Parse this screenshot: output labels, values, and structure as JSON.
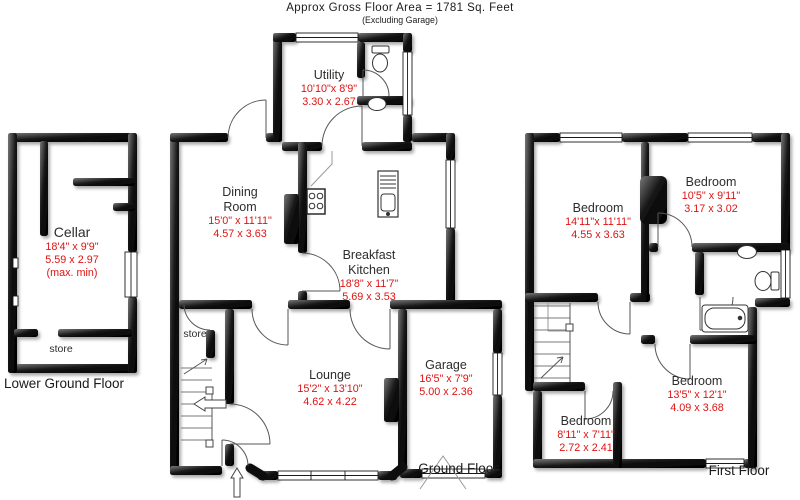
{
  "header": {
    "line1": "Approx Gross Floor Area  =  1781  Sq. Feet",
    "line2": "(Excluding Garage)"
  },
  "floors": {
    "lower_ground": {
      "label": "Lower Ground Floor"
    },
    "ground": {
      "label": "Ground Floor"
    },
    "first": {
      "label": "First Floor"
    }
  },
  "rooms": {
    "cellar": {
      "name": "Cellar",
      "dims_ft": "18'4\" x  9'9\"",
      "dims_m": "5.59  x  2.97",
      "note": "(max. min)"
    },
    "store_lower": {
      "name": "store"
    },
    "store_ground": {
      "name": "store"
    },
    "utility": {
      "name": "Utility",
      "dims_ft": "10'10\"x  8'9\"",
      "dims_m": "3.30  x  2.67"
    },
    "dining_room": {
      "name": "Dining\nRoom",
      "dims_ft": "15'0\" x 11'11\"",
      "dims_m": "4.57  x  3.63"
    },
    "breakfast_kitchen": {
      "name": "Breakfast\nKitchen",
      "dims_ft": "18'8\" x 11'7\"",
      "dims_m": "5.69  x  3.53"
    },
    "lounge": {
      "name": "Lounge",
      "dims_ft": "15'2\" x 13'10\"",
      "dims_m": "4.62  x  4.22"
    },
    "garage": {
      "name": "Garage",
      "dims_ft": "16'5\" x  7'9\"",
      "dims_m": "5.00  x  2.36"
    },
    "bedroom_1": {
      "name": "Bedroom",
      "dims_ft": "14'11\"x 11'11\"",
      "dims_m": "4.55  x  3.63"
    },
    "bedroom_2": {
      "name": "Bedroom",
      "dims_ft": "10'5\" x 9'11\"",
      "dims_m": "3.17  x  3.02"
    },
    "bedroom_3": {
      "name": "Bedroom",
      "dims_ft": "13'5\" x 12'1\"",
      "dims_m": "4.09  x  3.68"
    },
    "bedroom_4": {
      "name": "Bedroom",
      "dims_ft": "8'11\" x 7'11\"",
      "dims_m": "2.72  x  2.41"
    }
  },
  "colors": {
    "wall": "#000000",
    "dimension_text": "#e01313",
    "room_text": "#2d2d2d",
    "floor_label_text": "#1a1a1a"
  }
}
